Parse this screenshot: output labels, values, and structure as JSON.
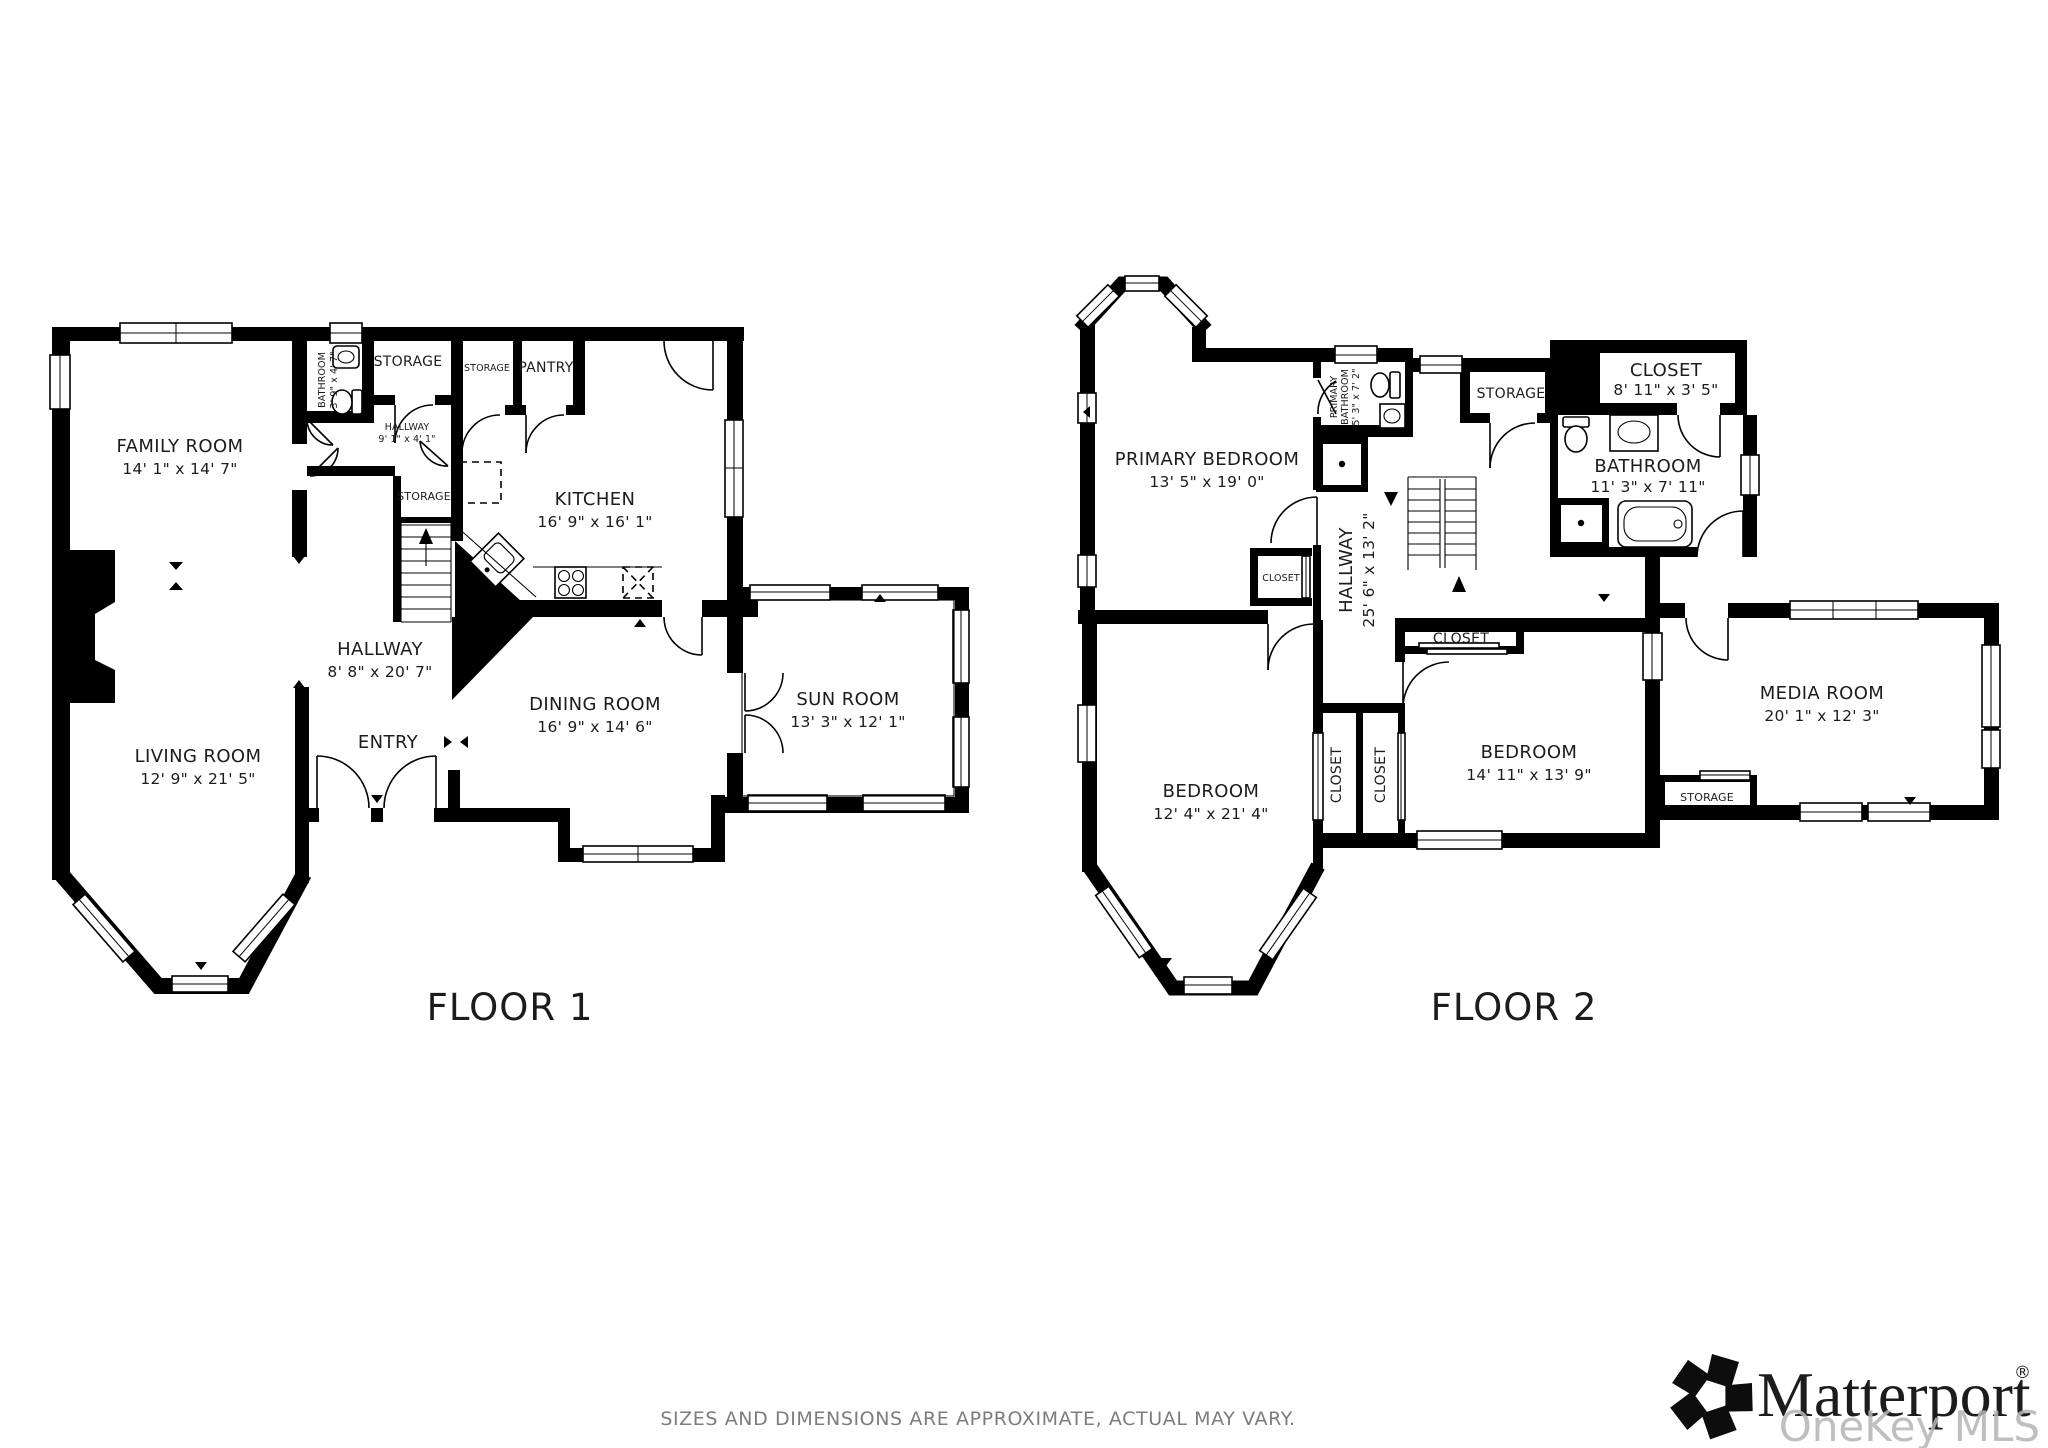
{
  "colors": {
    "wall": "#000000",
    "label": "#1c1c1c",
    "muted": "#7d7d7d",
    "watermark": "#b5b5b5"
  },
  "floor1": {
    "caption": "FLOOR 1",
    "rooms": {
      "family_room": {
        "name": "FAMILY ROOM",
        "dims": "14' 1\" x 14' 7\""
      },
      "living_room": {
        "name": "LIVING ROOM",
        "dims": "12' 9\" x 21' 5\""
      },
      "hallway": {
        "name": "HALLWAY",
        "dims": "8' 8\" x 20' 7\""
      },
      "entry": {
        "name": "ENTRY"
      },
      "kitchen": {
        "name": "KITCHEN",
        "dims": "16' 9\" x 16' 1\""
      },
      "dining_room": {
        "name": "DINING ROOM",
        "dims": "16' 9\" x 14' 6\""
      },
      "sun_room": {
        "name": "SUN ROOM",
        "dims": "13' 3\" x 12' 1\""
      },
      "bathroom": {
        "name": "BATHROOM",
        "dims": "3' 9\" x 4' 7\""
      },
      "storage_top": {
        "name": "STORAGE"
      },
      "storage_2": {
        "name": "STORAGE"
      },
      "pantry": {
        "name": "PANTRY"
      },
      "hallway_small": {
        "name": "HALLWAY",
        "dims": "9' 1\" x 4' 1\""
      },
      "storage_mid": {
        "name": "STORAGE"
      }
    }
  },
  "floor2": {
    "caption": "FLOOR 2",
    "rooms": {
      "primary_bedroom": {
        "name": "PRIMARY BEDROOM",
        "dims": "13' 5\" x 19' 0\""
      },
      "primary_bathroom": {
        "name_line1": "PRIMARY",
        "name_line2": "BATHROOM",
        "dims": "5' 3\" x 7' 2\""
      },
      "storage_top": {
        "name": "STORAGE"
      },
      "closet_top": {
        "name": "CLOSET",
        "dims": "8' 11\" x 3' 5\""
      },
      "bathroom": {
        "name": "BATHROOM",
        "dims": "11' 3\" x 7' 11\""
      },
      "hallway": {
        "name": "HALLWAY",
        "dims": "25' 6\" x 13' 2\""
      },
      "closet_small": {
        "name": "CLOSET"
      },
      "closet_bed1": {
        "name": "CLOSET"
      },
      "closet_bed2_side": {
        "name": "CLOSET"
      },
      "closet_bed2_top": {
        "name": "CLOSET"
      },
      "bedroom1": {
        "name": "BEDROOM",
        "dims": "12' 4\" x 21' 4\""
      },
      "bedroom2": {
        "name": "BEDROOM",
        "dims": "14' 11\" x 13' 9\""
      },
      "media_room": {
        "name": "MEDIA ROOM",
        "dims": "20' 1\" x 12' 3\""
      },
      "storage_media": {
        "name": "STORAGE"
      }
    }
  },
  "footer": {
    "disclaimer": "SIZES AND DIMENSIONS ARE APPROXIMATE, ACTUAL MAY VARY.",
    "brand": "Matterport",
    "brand_registered": "®",
    "watermark": "OneKey MLS"
  }
}
